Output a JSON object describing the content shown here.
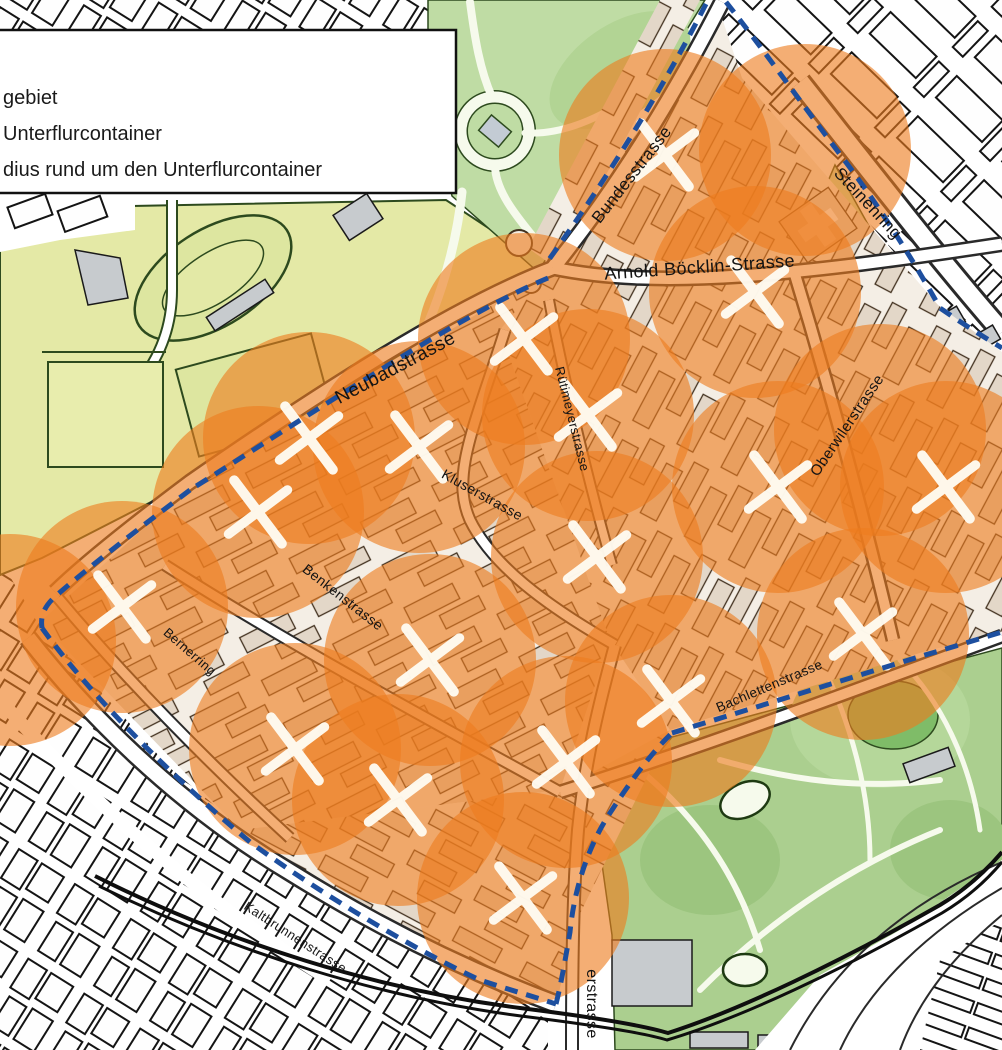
{
  "legend": {
    "items": [
      {
        "id": "perimeter-area",
        "label": "gebiet"
      },
      {
        "id": "unterflurcontainer",
        "label": "Unterflurcontainer"
      },
      {
        "id": "radius",
        "label": "dius rund um den Unterflurcontainer"
      }
    ]
  },
  "streets": [
    {
      "id": "bundesstrasse",
      "label": "Bundesstrasse",
      "x": 636,
      "y": 178,
      "rot": -52,
      "fs": 17
    },
    {
      "id": "arnold-boecklin-strasse",
      "label": "Arnold Böcklin-Strasse",
      "x": 700,
      "y": 273,
      "rot": -4,
      "fs": 18
    },
    {
      "id": "steinenring",
      "label": "Steinenring",
      "x": 864,
      "y": 207,
      "rot": 47,
      "fs": 17
    },
    {
      "id": "neubadstrasse",
      "label": "Neubadstrasse",
      "x": 398,
      "y": 373,
      "rot": -28,
      "fs": 19
    },
    {
      "id": "ruetimeyerstrasse",
      "label": "Rütimeyerstrasse",
      "x": 568,
      "y": 420,
      "rot": 76,
      "fs": 13
    },
    {
      "id": "kluserstrasse",
      "label": "Kluserstrasse",
      "x": 480,
      "y": 499,
      "rot": 29,
      "fs": 14
    },
    {
      "id": "benkenstrasse",
      "label": "Benkenstrasse",
      "x": 340,
      "y": 601,
      "rot": 38,
      "fs": 14
    },
    {
      "id": "bernerring",
      "label": "Bernerring",
      "x": 187,
      "y": 655,
      "rot": 41,
      "fs": 13
    },
    {
      "id": "oberwilerstrasse",
      "label": "Oberwilerstrasse",
      "x": 851,
      "y": 428,
      "rot": -56,
      "fs": 15
    },
    {
      "id": "bachlettenstrasse",
      "label": "Bachlettenstrasse",
      "x": 771,
      "y": 690,
      "rot": -23,
      "fs": 13.5
    },
    {
      "id": "kaltbrunnenstrasse",
      "label": "Kaltbrunnenstrasse",
      "x": 293,
      "y": 941,
      "rot": 33,
      "fs": 13
    },
    {
      "id": "wanderstrasse-partial",
      "label": "erstrasse",
      "x": 587,
      "y": 1004,
      "rot": 90,
      "fs": 16
    }
  ],
  "containers": {
    "marker_color": "#FFFCF2",
    "positions": [
      [
        665,
        155
      ],
      [
        755,
        292
      ],
      [
        524,
        339
      ],
      [
        309,
        438
      ],
      [
        419,
        447
      ],
      [
        588,
        415
      ],
      [
        258,
        512
      ],
      [
        122,
        607
      ],
      [
        597,
        557
      ],
      [
        778,
        487
      ],
      [
        946,
        487
      ],
      [
        863,
        634
      ],
      [
        430,
        660
      ],
      [
        295,
        749
      ],
      [
        566,
        762
      ],
      [
        671,
        701
      ],
      [
        398,
        800
      ],
      [
        523,
        898
      ]
    ]
  },
  "coverage": {
    "radius_px": 106,
    "fill": "#EE7D1F",
    "opacity": 0.62,
    "extra_centers": [
      [
        805,
        150
      ],
      [
        880,
        430
      ],
      [
        10,
        640
      ]
    ]
  },
  "boundary": {
    "color": "#1D4F9F",
    "width": 5,
    "dash": "13 9"
  },
  "colors": {
    "park_green": "#E4E9A6",
    "lawn_green": "#BFDCA4",
    "zoo_green": "#ABCF8F",
    "building_gray": "#C7CBCE",
    "building_tan": "#E3D7C8",
    "outline": "#1A1A1A",
    "background": "#FFFFFF"
  }
}
